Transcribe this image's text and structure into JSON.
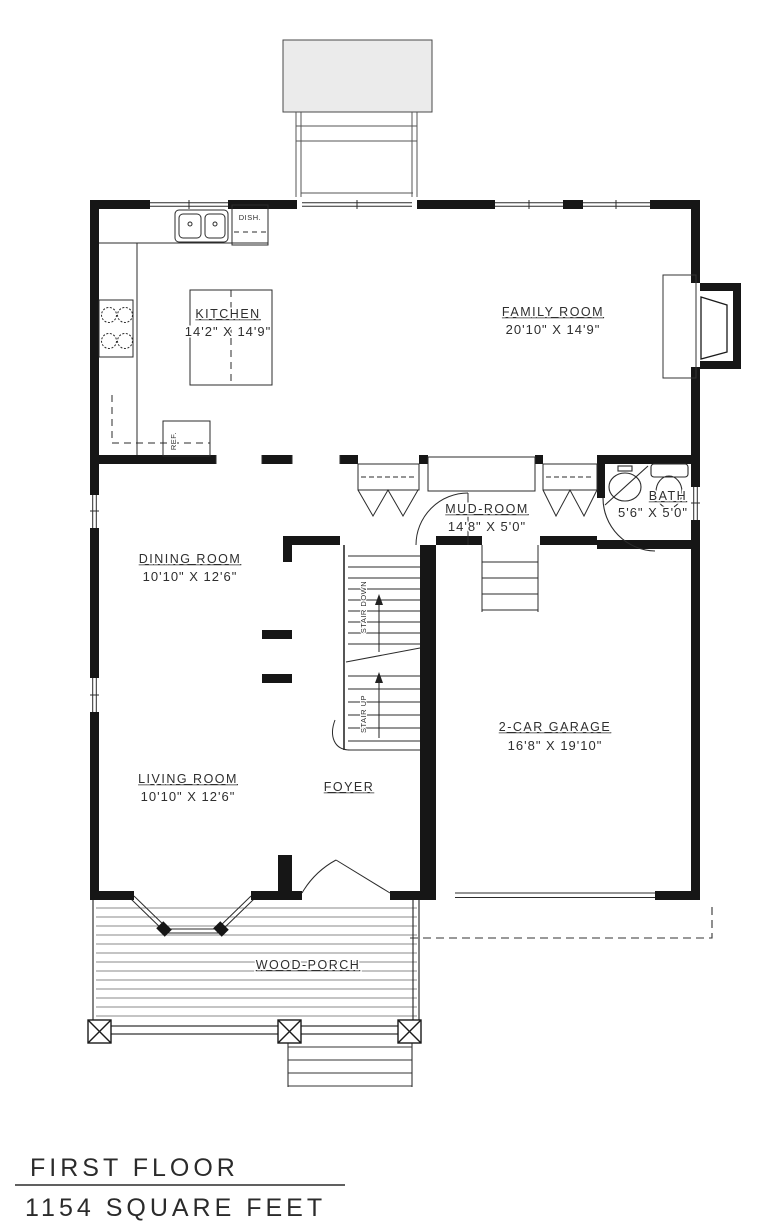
{
  "plan": {
    "rooms": {
      "kitchen": {
        "name": "KITCHEN",
        "dims": "14'2\" X 14'9\""
      },
      "family_room": {
        "name": "FAMILY ROOM",
        "dims": "20'10\" X 14'9\""
      },
      "mud_room": {
        "name": "MUD-ROOM",
        "dims": "14'8\" X 5'0\""
      },
      "bath": {
        "name": "BATH",
        "dims": "5'6\" X 5'0\""
      },
      "dining_room": {
        "name": "DINING ROOM",
        "dims": "10'10\" X 12'6\""
      },
      "living_room": {
        "name": "LIVING ROOM",
        "dims": "10'10\" X 12'6\""
      },
      "garage": {
        "name": "2-CAR GARAGE",
        "dims": "16'8\" X 19'10\""
      },
      "foyer": {
        "name": "FOYER"
      },
      "porch": {
        "name": "WOOD-PORCH"
      }
    },
    "labels": {
      "stair_down": "STAIR DOWN",
      "stair_up": "STAIR UP",
      "dishwasher": "DISH.",
      "refrigerator": "REF."
    },
    "title_block": {
      "floor": "FIRST FLOOR",
      "area": "1154 SQUARE FEET"
    },
    "colors": {
      "line": "#1a1a1a",
      "background": "#ffffff"
    }
  }
}
